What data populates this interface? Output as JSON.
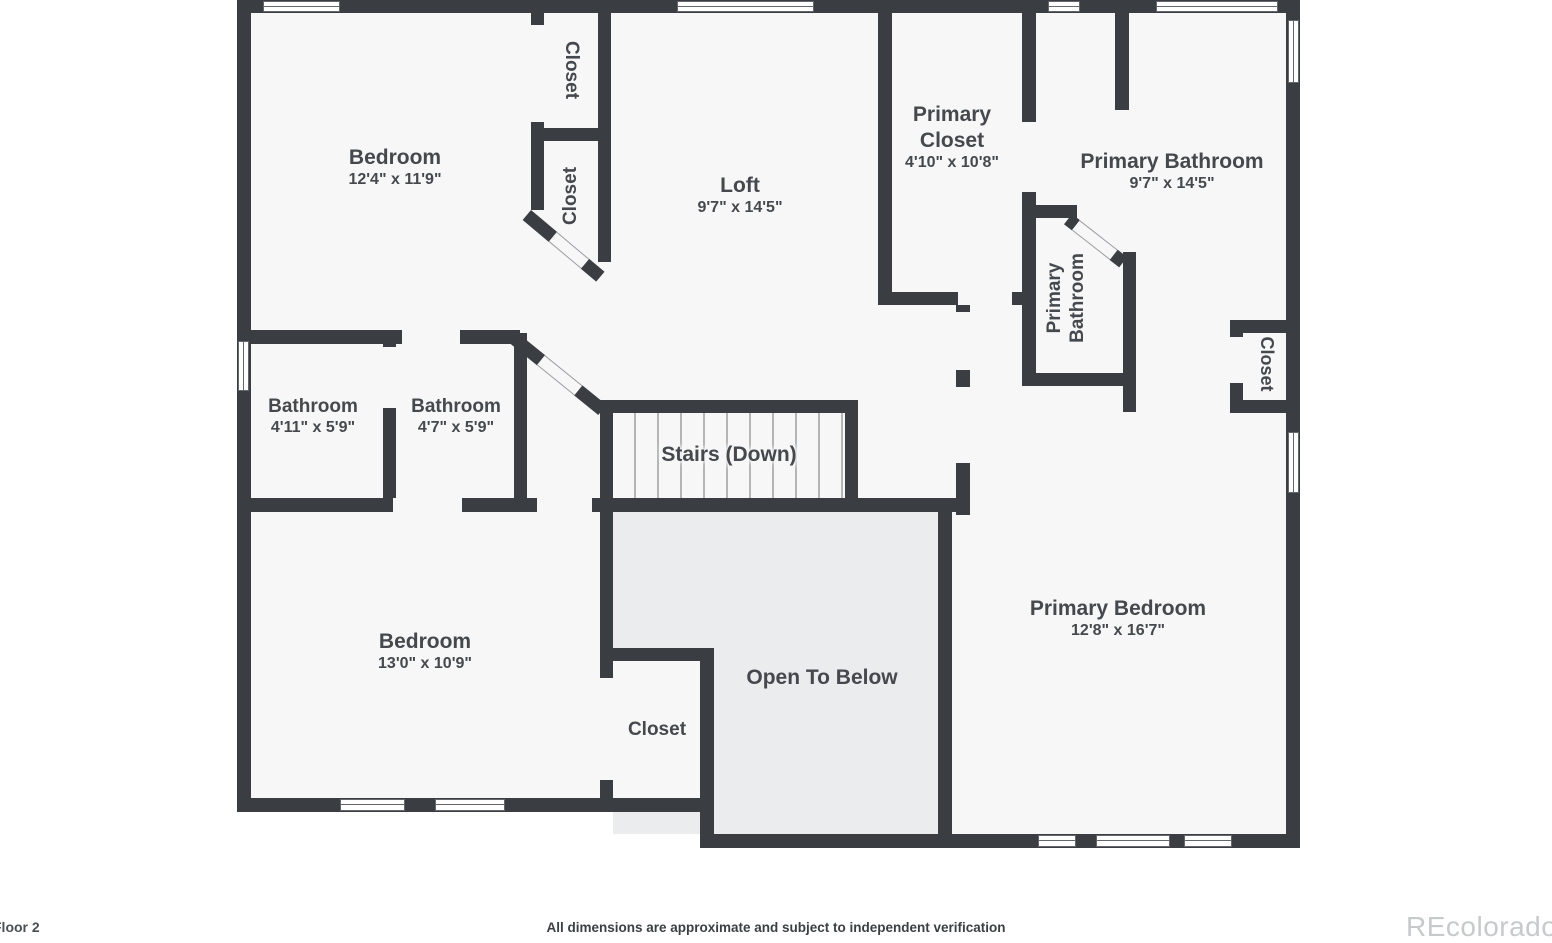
{
  "colors": {
    "wall": "#3a3d41",
    "floor": "#f7f7f8",
    "openBelow": "#ebecee",
    "label": "#45484c"
  },
  "rooms": [
    {
      "id": "bedroom-top",
      "name": "Bedroom",
      "dims": "12'4\" x 11'9\""
    },
    {
      "id": "closet-top-1",
      "name": "Closet"
    },
    {
      "id": "closet-top-2",
      "name": "Closet"
    },
    {
      "id": "loft",
      "name": "Loft",
      "dims": "9'7\" x 14'5\""
    },
    {
      "id": "primary-closet",
      "name": "Primary Closet",
      "dims": "4'10\" x 10'8\""
    },
    {
      "id": "primary-bathroom",
      "name": "Primary Bathroom",
      "dims": "9'7\" x 14'5\""
    },
    {
      "id": "primary-bathroom-wc",
      "name": "Primary Bathroom"
    },
    {
      "id": "closet-right",
      "name": "Closet"
    },
    {
      "id": "bathroom-1",
      "name": "Bathroom",
      "dims": "4'11\" x 5'9\""
    },
    {
      "id": "bathroom-2",
      "name": "Bathroom",
      "dims": "4'7\" x 5'9\""
    },
    {
      "id": "stairs",
      "name": "Stairs (Down)"
    },
    {
      "id": "bedroom-bottom",
      "name": "Bedroom",
      "dims": "13'0\" x 10'9\""
    },
    {
      "id": "closet-bottom",
      "name": "Closet"
    },
    {
      "id": "open-below",
      "name": "Open To Below"
    },
    {
      "id": "primary-bedroom",
      "name": "Primary Bedroom",
      "dims": "12'8\" x 16'7\""
    }
  ],
  "footer": {
    "floor_label": "Floor 2",
    "disclaimer": "All dimensions are approximate and subject to independent verification",
    "watermark": "REcolorado"
  }
}
